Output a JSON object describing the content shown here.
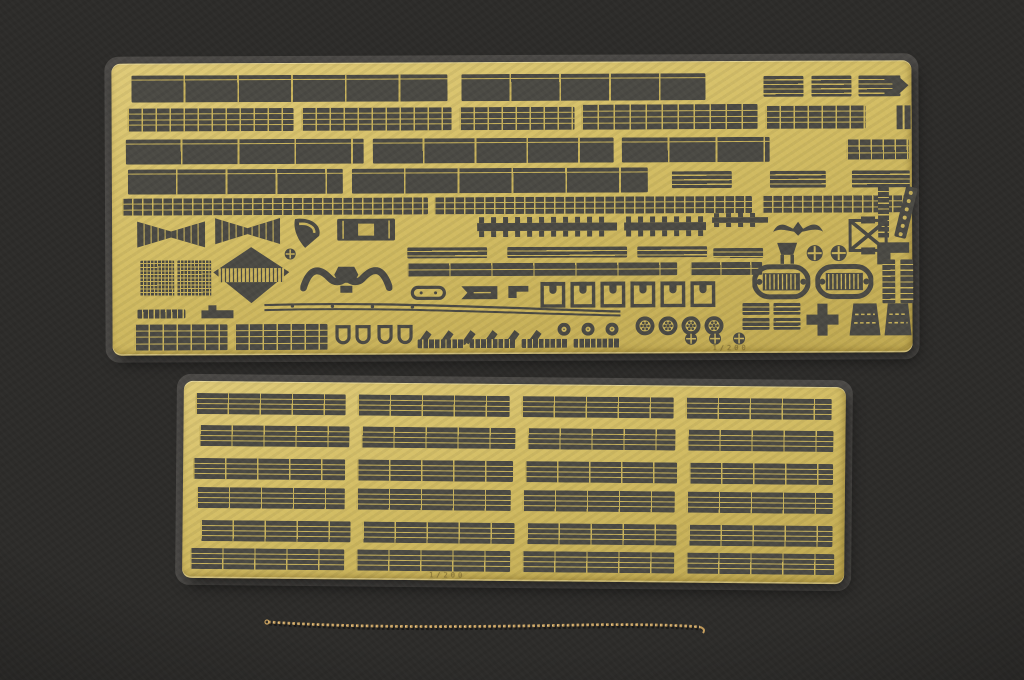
{
  "scene": {
    "subject": "Two photo-etched brass model-kit detail sheets (railings and fittings) with a fine brass chain, laid on a dark charcoal background",
    "palette": {
      "background": "#2d2c2a",
      "brass": "#d3bd64",
      "brass_hi": "#dfca78",
      "brass_lo": "#c0a951",
      "opening": "#4b4a44",
      "etch_line": "#c9b35c",
      "film": "rgba(170,168,158,0.26)",
      "chain": "#c79f5d",
      "chain_hi": "#ecd19a"
    }
  },
  "fret_top": {
    "x": 112,
    "y": 62,
    "w": 800,
    "h": 292,
    "rotation": -0.25,
    "marking": "1/200",
    "parts": [
      {
        "t": "panels",
        "x": 20,
        "y": 12,
        "w": 316,
        "h": 27,
        "sp": 52
      },
      {
        "t": "panels",
        "x": 350,
        "y": 12,
        "w": 244,
        "h": 27,
        "sp": 48
      },
      {
        "t": "grate",
        "x": 652,
        "y": 15,
        "w": 40,
        "h": 21
      },
      {
        "t": "grate",
        "x": 700,
        "y": 15,
        "w": 40,
        "h": 21
      },
      {
        "t": "grate",
        "x": 747,
        "y": 15,
        "w": 42,
        "h": 21
      },
      {
        "t": "arrow",
        "x": 772,
        "y": 11,
        "w": 26,
        "h": 28
      },
      {
        "t": "rail",
        "x": 16,
        "y": 45,
        "w": 166,
        "h": 23,
        "sp": 14,
        "lines": 3
      },
      {
        "t": "rail",
        "x": 190,
        "y": 45,
        "w": 150,
        "h": 23,
        "sp": 14,
        "lines": 3
      },
      {
        "t": "rail",
        "x": 348,
        "y": 45,
        "w": 115,
        "h": 23,
        "sp": 14,
        "lines": 3
      },
      {
        "t": "rail",
        "x": 470,
        "y": 43,
        "w": 176,
        "h": 25,
        "sp": 16,
        "lines": 3
      },
      {
        "t": "rail",
        "x": 654,
        "y": 45,
        "w": 100,
        "h": 23,
        "sp": 14,
        "lines": 3
      },
      {
        "t": "bars2",
        "x": 784,
        "y": 45,
        "w": 16,
        "h": 24
      },
      {
        "t": "panels",
        "x": 14,
        "y": 76,
        "w": 238,
        "h": 25,
        "sp": 55
      },
      {
        "t": "panels",
        "x": 261,
        "y": 76,
        "w": 241,
        "h": 25,
        "sp": 50
      },
      {
        "t": "panels",
        "x": 510,
        "y": 76,
        "w": 148,
        "h": 25,
        "sp": 46
      },
      {
        "t": "rail",
        "x": 735,
        "y": 79,
        "w": 62,
        "h": 20,
        "sp": 12,
        "lines": 2
      },
      {
        "t": "panels",
        "x": 16,
        "y": 106,
        "w": 215,
        "h": 25,
        "sp": 48
      },
      {
        "t": "panels",
        "x": 240,
        "y": 106,
        "w": 296,
        "h": 25,
        "sp": 52
      },
      {
        "t": "grate",
        "x": 560,
        "y": 110,
        "w": 60,
        "h": 17
      },
      {
        "t": "grate",
        "x": 658,
        "y": 110,
        "w": 56,
        "h": 17
      },
      {
        "t": "grate",
        "x": 740,
        "y": 110,
        "w": 58,
        "h": 17
      },
      {
        "t": "rail",
        "x": 10,
        "y": 135,
        "w": 306,
        "h": 17,
        "sp": 10,
        "lines": 2
      },
      {
        "t": "rail",
        "x": 322,
        "y": 135,
        "w": 318,
        "h": 17,
        "sp": 10,
        "lines": 2
      },
      {
        "t": "rail",
        "x": 650,
        "y": 135,
        "w": 146,
        "h": 17,
        "sp": 10,
        "lines": 2
      },
      {
        "t": "vladder",
        "x": 766,
        "y": 126,
        "w": 11,
        "h": 52
      },
      {
        "t": "dialadder",
        "x": 781,
        "y": 124,
        "w": 26,
        "h": 56
      },
      {
        "t": "fan",
        "x": 25,
        "y": 156,
        "w": 68,
        "h": 30
      },
      {
        "t": "fan",
        "x": 103,
        "y": 153,
        "w": 65,
        "h": 30
      },
      {
        "t": "wedge",
        "x": 178,
        "y": 154,
        "w": 35,
        "h": 33
      },
      {
        "t": "boxin",
        "x": 225,
        "y": 156,
        "w": 58,
        "h": 22
      },
      {
        "t": "rack",
        "x": 365,
        "y": 155,
        "w": 140,
        "h": 20
      },
      {
        "t": "rack",
        "x": 512,
        "y": 155,
        "w": 82,
        "h": 20
      },
      {
        "t": "rack",
        "x": 600,
        "y": 152,
        "w": 56,
        "h": 14
      },
      {
        "t": "eagle",
        "x": 660,
        "y": 156,
        "w": 52,
        "h": 20
      },
      {
        "t": "xbrace",
        "x": 736,
        "y": 156,
        "w": 40,
        "h": 38
      },
      {
        "t": "grate",
        "x": 295,
        "y": 185,
        "w": 80,
        "h": 11
      },
      {
        "t": "grate",
        "x": 395,
        "y": 185,
        "w": 120,
        "h": 11
      },
      {
        "t": "grate",
        "x": 525,
        "y": 185,
        "w": 70,
        "h": 11
      },
      {
        "t": "grate",
        "x": 601,
        "y": 187,
        "w": 50,
        "h": 10
      },
      {
        "t": "bucket",
        "x": 663,
        "y": 181,
        "w": 24,
        "h": 24
      },
      {
        "t": "disccross",
        "x": 694,
        "y": 184,
        "w": 17,
        "h": 17
      },
      {
        "t": "disccross",
        "x": 718,
        "y": 184,
        "w": 17,
        "h": 17
      },
      {
        "t": "Lb",
        "x": 764,
        "y": 181,
        "w": 34,
        "h": 24
      },
      {
        "t": "mesh",
        "x": 28,
        "y": 197,
        "w": 34,
        "h": 36
      },
      {
        "t": "mesh",
        "x": 65,
        "y": 197,
        "w": 34,
        "h": 36
      },
      {
        "t": "diamond",
        "x": 100,
        "y": 183,
        "w": 78,
        "h": 58
      },
      {
        "t": "disccross",
        "x": 172,
        "y": 185,
        "w": 12,
        "h": 12
      },
      {
        "t": "ywave",
        "x": 188,
        "y": 197,
        "w": 92,
        "h": 36
      },
      {
        "t": "rail",
        "x": 295,
        "y": 201,
        "w": 270,
        "h": 13,
        "sp": 42,
        "lines": 1
      },
      {
        "t": "rail",
        "x": 578,
        "y": 201,
        "w": 72,
        "h": 13,
        "sp": 30,
        "lines": 1
      },
      {
        "t": "boat",
        "x": 640,
        "y": 203,
        "w": 58,
        "h": 36
      },
      {
        "t": "boat",
        "x": 703,
        "y": 203,
        "w": 58,
        "h": 36
      },
      {
        "t": "vladder",
        "x": 770,
        "y": 199,
        "w": 13,
        "h": 44
      },
      {
        "t": "vladder",
        "x": 788,
        "y": 199,
        "w": 13,
        "h": 44
      },
      {
        "t": "ovaltrack",
        "x": 298,
        "y": 223,
        "w": 36,
        "h": 15
      },
      {
        "t": "flag",
        "x": 348,
        "y": 223,
        "w": 38,
        "h": 15
      },
      {
        "t": "Lb",
        "x": 395,
        "y": 223,
        "w": 22,
        "h": 14
      },
      {
        "t": "uclip",
        "x": 428,
        "y": 220,
        "w": 25,
        "h": 26,
        "repeat": 6,
        "dx": 30
      },
      {
        "t": "ladder",
        "x": 25,
        "y": 246,
        "w": 48,
        "h": 9
      },
      {
        "t": "notch",
        "x": 88,
        "y": 241,
        "w": 34,
        "h": 15
      },
      {
        "t": "strake",
        "x": 150,
        "y": 239,
        "w": 360,
        "h": 16
      },
      {
        "t": "hook",
        "x": 303,
        "y": 266,
        "w": 18,
        "h": 18,
        "repeat": 6,
        "dx": 22
      },
      {
        "t": "discdot",
        "x": 445,
        "y": 261,
        "w": 13,
        "h": 13,
        "repeat": 3,
        "dx": 24
      },
      {
        "t": "discspoke",
        "x": 523,
        "y": 255,
        "w": 19,
        "h": 19,
        "repeat": 4,
        "dx": 23
      },
      {
        "t": "ladder",
        "x": 305,
        "y": 277,
        "w": 46,
        "h": 9,
        "repeat": 4,
        "dx": 52
      },
      {
        "t": "disccross",
        "x": 572,
        "y": 271,
        "w": 13,
        "h": 13,
        "repeat": 3,
        "dx": 24
      },
      {
        "t": "rail",
        "x": 22,
        "y": 261,
        "w": 93,
        "h": 26,
        "sp": 14,
        "lines": 3
      },
      {
        "t": "rail",
        "x": 122,
        "y": 261,
        "w": 93,
        "h": 26,
        "sp": 14,
        "lines": 3
      },
      {
        "t": "dshape",
        "x": 222,
        "y": 262,
        "w": 17,
        "h": 23,
        "repeat": 2,
        "dx": 20
      },
      {
        "t": "dshape",
        "x": 264,
        "y": 262,
        "w": 17,
        "h": 23,
        "repeat": 2,
        "dx": 20
      },
      {
        "t": "grate",
        "x": 630,
        "y": 242,
        "w": 27,
        "h": 12
      },
      {
        "t": "grate",
        "x": 630,
        "y": 257,
        "w": 27,
        "h": 12
      },
      {
        "t": "grate",
        "x": 661,
        "y": 242,
        "w": 27,
        "h": 12
      },
      {
        "t": "grate",
        "x": 661,
        "y": 257,
        "w": 27,
        "h": 12
      },
      {
        "t": "cross",
        "x": 692,
        "y": 241,
        "w": 36,
        "h": 36
      },
      {
        "t": "trap",
        "x": 736,
        "y": 242,
        "w": 33,
        "h": 34
      },
      {
        "t": "trap",
        "x": 771,
        "y": 242,
        "w": 29,
        "h": 34
      },
      {
        "t": "textfaint",
        "x": 600,
        "y": 283,
        "w": 170,
        "h": 9,
        "bind": "fret_top.marking"
      }
    ]
  },
  "fret_bottom": {
    "x": 183,
    "y": 384,
    "w": 662,
    "h": 197,
    "rotation": 0.55,
    "marking": "1/200",
    "rail": {
      "h": 21,
      "sp": 32,
      "lines": 3
    },
    "rows": [
      {
        "y": 12,
        "segs": [
          [
            12,
            150
          ],
          [
            174,
            152
          ],
          [
            338,
            152
          ],
          [
            502,
            146
          ]
        ]
      },
      {
        "y": 44,
        "segs": [
          [
            16,
            150
          ],
          [
            178,
            154
          ],
          [
            344,
            148
          ],
          [
            504,
            146
          ]
        ]
      },
      {
        "y": 77,
        "segs": [
          [
            10,
            152
          ],
          [
            174,
            156
          ],
          [
            342,
            152
          ],
          [
            506,
            144
          ]
        ]
      },
      {
        "y": 106,
        "segs": [
          [
            14,
            148
          ],
          [
            174,
            154
          ],
          [
            340,
            152
          ],
          [
            504,
            146
          ]
        ]
      },
      {
        "y": 139,
        "segs": [
          [
            18,
            150
          ],
          [
            180,
            152
          ],
          [
            344,
            150
          ],
          [
            506,
            144
          ]
        ]
      },
      {
        "y": 167,
        "segs": [
          [
            8,
            154
          ],
          [
            174,
            154
          ],
          [
            340,
            152
          ],
          [
            504,
            148
          ]
        ]
      }
    ],
    "marking_pos": {
      "x": 247,
      "y": 188,
      "w": 280,
      "h": 9
    }
  },
  "chain": {
    "path": "M268 622 C360 628 470 627 580 625 C630 624 680 625 700 627",
    "curl": "M700 627 q6 2 3 6",
    "start_loop": {
      "x": 267,
      "y": 622,
      "r": 2
    },
    "color": "#c79f5d",
    "highlight": "#ecd19a",
    "dash": "2.6 2.3",
    "width": 2.8
  }
}
